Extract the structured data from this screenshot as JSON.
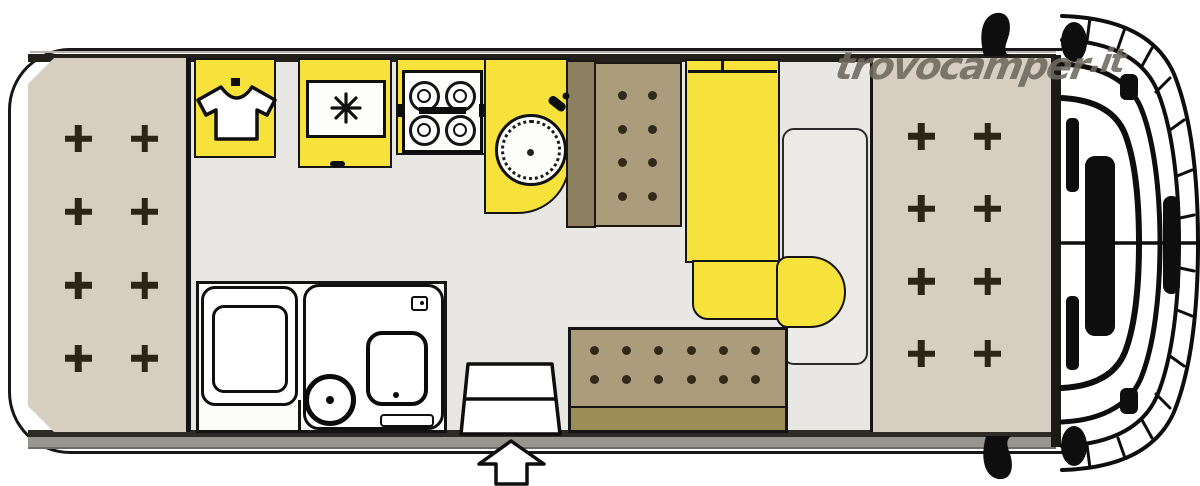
{
  "watermark": {
    "site": "trovocamper",
    "tld": ".it"
  },
  "colors": {
    "yellow": "#f6e23a",
    "beige": "#d6cec0",
    "seat": "#ab9c7c",
    "seat_back": "#8d8061",
    "bench_back": "#9c8c56",
    "floor": "#e9e7e3",
    "wall": "#23201b",
    "wall_gray": "#97958f",
    "line": "#141414",
    "watermark": "#6e695f"
  },
  "grids": {
    "left-bed-crosses": {
      "rows": 4,
      "cols": 2,
      "shape": "cross"
    },
    "right-bed-crosses": {
      "rows": 4,
      "cols": 2,
      "shape": "cross"
    },
    "dinette-dots": {
      "rows": 4,
      "cols": 2,
      "shape": "dot"
    },
    "bench-dots": {
      "rows": 2,
      "cols": 6,
      "shape": "dot"
    },
    "stove-burners": {
      "rows": 2,
      "cols": 2,
      "shape": "burner"
    }
  },
  "plan": {
    "type": "camper-van-floorplan",
    "areas": {
      "rear_bed": {
        "label": "rear bed",
        "cross_marks": 8
      },
      "wardrobe": {
        "label": "wardrobe",
        "icon": "shirt-icon"
      },
      "refrigerator": {
        "label": "refrigerator",
        "icon": "snowflake-icon"
      },
      "stove": {
        "label": "hob",
        "burners": 4
      },
      "sink": {
        "label": "kitchen sink"
      },
      "dinette_seat": {
        "label": "front dinette seat",
        "dots": 8
      },
      "sofa": {
        "label": "L-shaped sofa"
      },
      "table": {
        "label": "dinette table"
      },
      "side_bench": {
        "label": "side bench",
        "dots": 12
      },
      "bathroom": {
        "shower": "shower",
        "toilet": "toilet",
        "washbasin": "washbasin"
      },
      "entrance": {
        "label": "entrance door",
        "indicator": "up-arrow"
      },
      "front_bed": {
        "label": "front bed",
        "cross_marks": 8
      },
      "cab": {
        "label": "driver cab"
      }
    }
  }
}
